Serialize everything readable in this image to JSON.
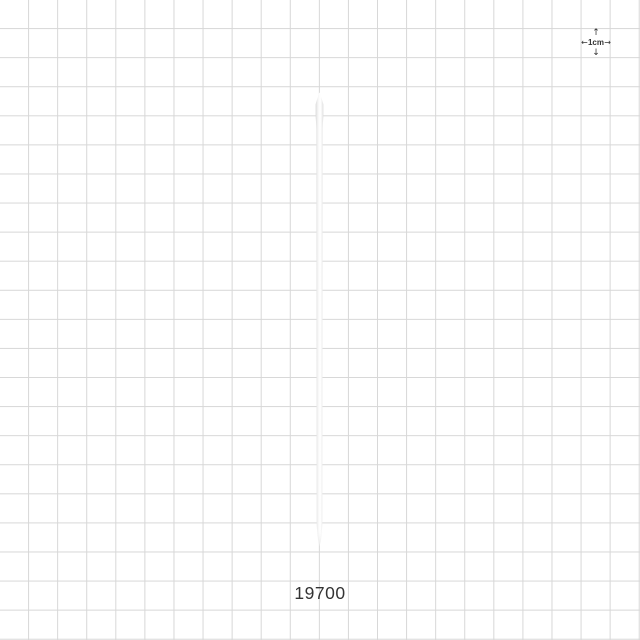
{
  "product": {
    "part_number": "19700"
  },
  "scale_indicator": {
    "label": "1cm",
    "icons": {
      "up": "↑",
      "down": "↓",
      "left": "←",
      "right": "→"
    }
  },
  "colors": {
    "background": "#ffffff",
    "grid_line": "#d7d7d7",
    "text": "#333333",
    "rod_edge": "#d8d8d8",
    "rod_body": "#ffffff"
  }
}
